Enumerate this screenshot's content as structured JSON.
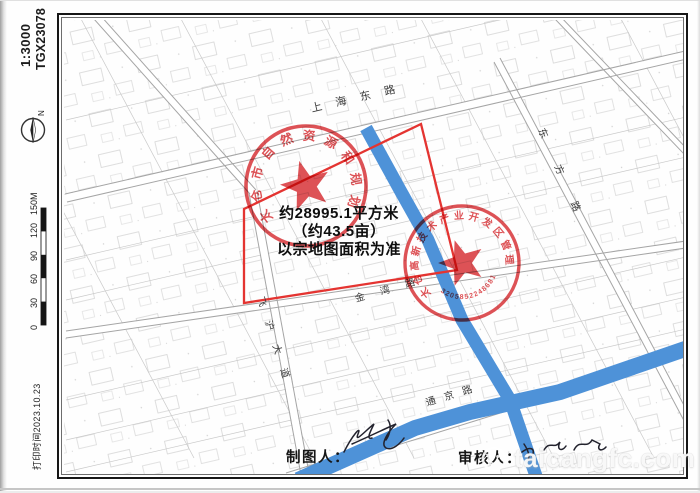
{
  "sheet": {
    "scale_label": "1:3000",
    "plot_number": "TGX23078",
    "print_time": "打印时间2023.10.23",
    "compass_north_label": "N",
    "scale_bar_labels": [
      "0",
      "30",
      "60",
      "90",
      "120",
      "150M"
    ]
  },
  "map": {
    "streets": [
      {
        "name": "上海东路"
      },
      {
        "name": "东方路"
      },
      {
        "name": "飞沪大道"
      },
      {
        "name": "金湾路"
      },
      {
        "name": "通京路"
      }
    ],
    "parcel": {
      "area_sqm": "约28995.1平方米",
      "area_mu": "（约43.5亩）",
      "note": "以宗地图面积为准"
    },
    "stamps": [
      {
        "ring_text": "太仓市自然资源和规划局"
      },
      {
        "ring_text": "太仓高新技术产业开发区管理委员会",
        "number": "3205852248681"
      }
    ]
  },
  "footer": {
    "maker_label": "制图人：",
    "reviewer_label": "审核人："
  },
  "watermark": {
    "text": "taicangfc.com"
  },
  "colors": {
    "stamp": "#d93a3e",
    "parcel": "#e43431",
    "water": "#4e92d8"
  }
}
